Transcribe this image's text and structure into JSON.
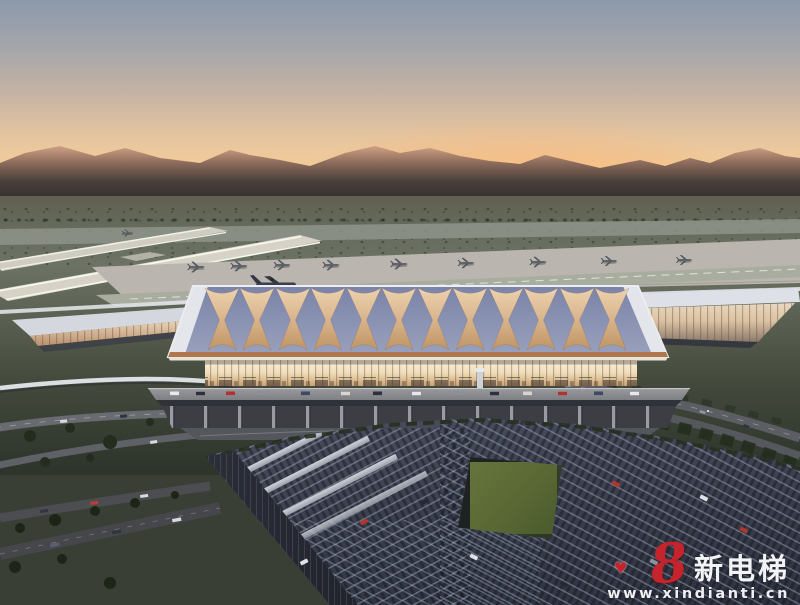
{
  "image": {
    "type": "architectural-rendering",
    "subject": "Aerial dusk view of an airport terminal with lattice-spire roof, airfield behind and rooftop car park in front",
    "width_px": 800,
    "height_px": 605
  },
  "watermark": {
    "logo_glyph": "8",
    "heart_icon": "♥",
    "brand_text": "新电梯",
    "site_url": "www.xindianti.cn",
    "logo_color": "#c5242c",
    "text_color": "#f2f3f5"
  },
  "palette": {
    "sky_top": "#8d99ab",
    "sky_horizon": "#f6c98c",
    "sunset_glow": "#ffba6e",
    "mountain_lit": "#cfa184",
    "mountain_shadow": "#3a3433",
    "field_green": "#3c4435",
    "terminal_roof": "#8289ac",
    "spire_gold": "#d9b58d",
    "glass_glow": "#f6e8cd",
    "copper_trim": "#b0774e",
    "parking_deck": "#3e4251",
    "courtyard_green": "#5c6c38"
  },
  "scene": {
    "sky": "dusk gradient sky",
    "mountains": "distant mountain range lit by sunset",
    "airfield": "runways and apron with parked aircraft",
    "terminal": "main terminal hall with woven golden roof spires",
    "wings": "glowing glass concourse wings",
    "roads": "curved elevated access roads with traffic",
    "parking": "rooftop car park with sunken green courtyard"
  }
}
